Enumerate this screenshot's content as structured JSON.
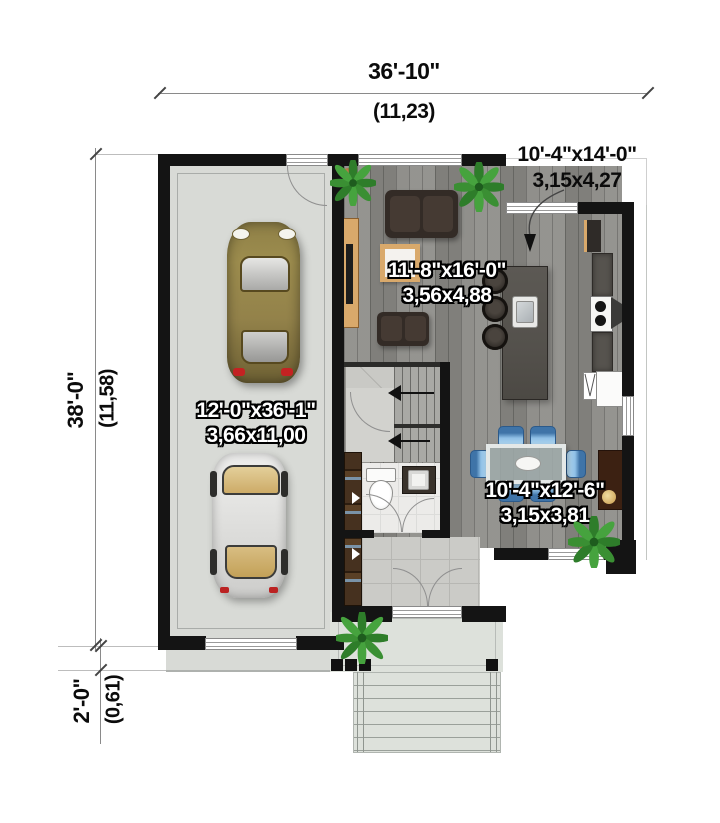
{
  "plan": {
    "dims": {
      "top": {
        "imperial": "36'-10\"",
        "metric": "(11,23)"
      },
      "left": {
        "imperial": "38'-0\"",
        "metric": "(11,58)"
      },
      "porch": {
        "imperial": "2'-0\"",
        "metric": "(0,61)"
      }
    },
    "rooms": {
      "kitchen": {
        "imperial": "10'-4\"x14'-0\"",
        "metric": "3,15x4,27"
      },
      "living": {
        "imperial": "11'-8\"x16'-0\"",
        "metric": "3,56x4,88"
      },
      "garage": {
        "imperial": "12'-0\"x36'-1\"",
        "metric": "3,66x11,00"
      },
      "dining": {
        "imperial": "10'-4\"x12'-6\"",
        "metric": "3,15x3,81"
      }
    },
    "colors": {
      "wall": "#141414",
      "wood_floor": "#8e8d89",
      "garage_floor": "#d8dad6",
      "entry_tile": "#cbcbc7",
      "accent_wood": "#d9a96b",
      "chair_blue": "#7fb2d9",
      "plant_green": "#3b8a34",
      "car_gold": "#93824a",
      "car_silver": "#e2e2e0"
    }
  }
}
